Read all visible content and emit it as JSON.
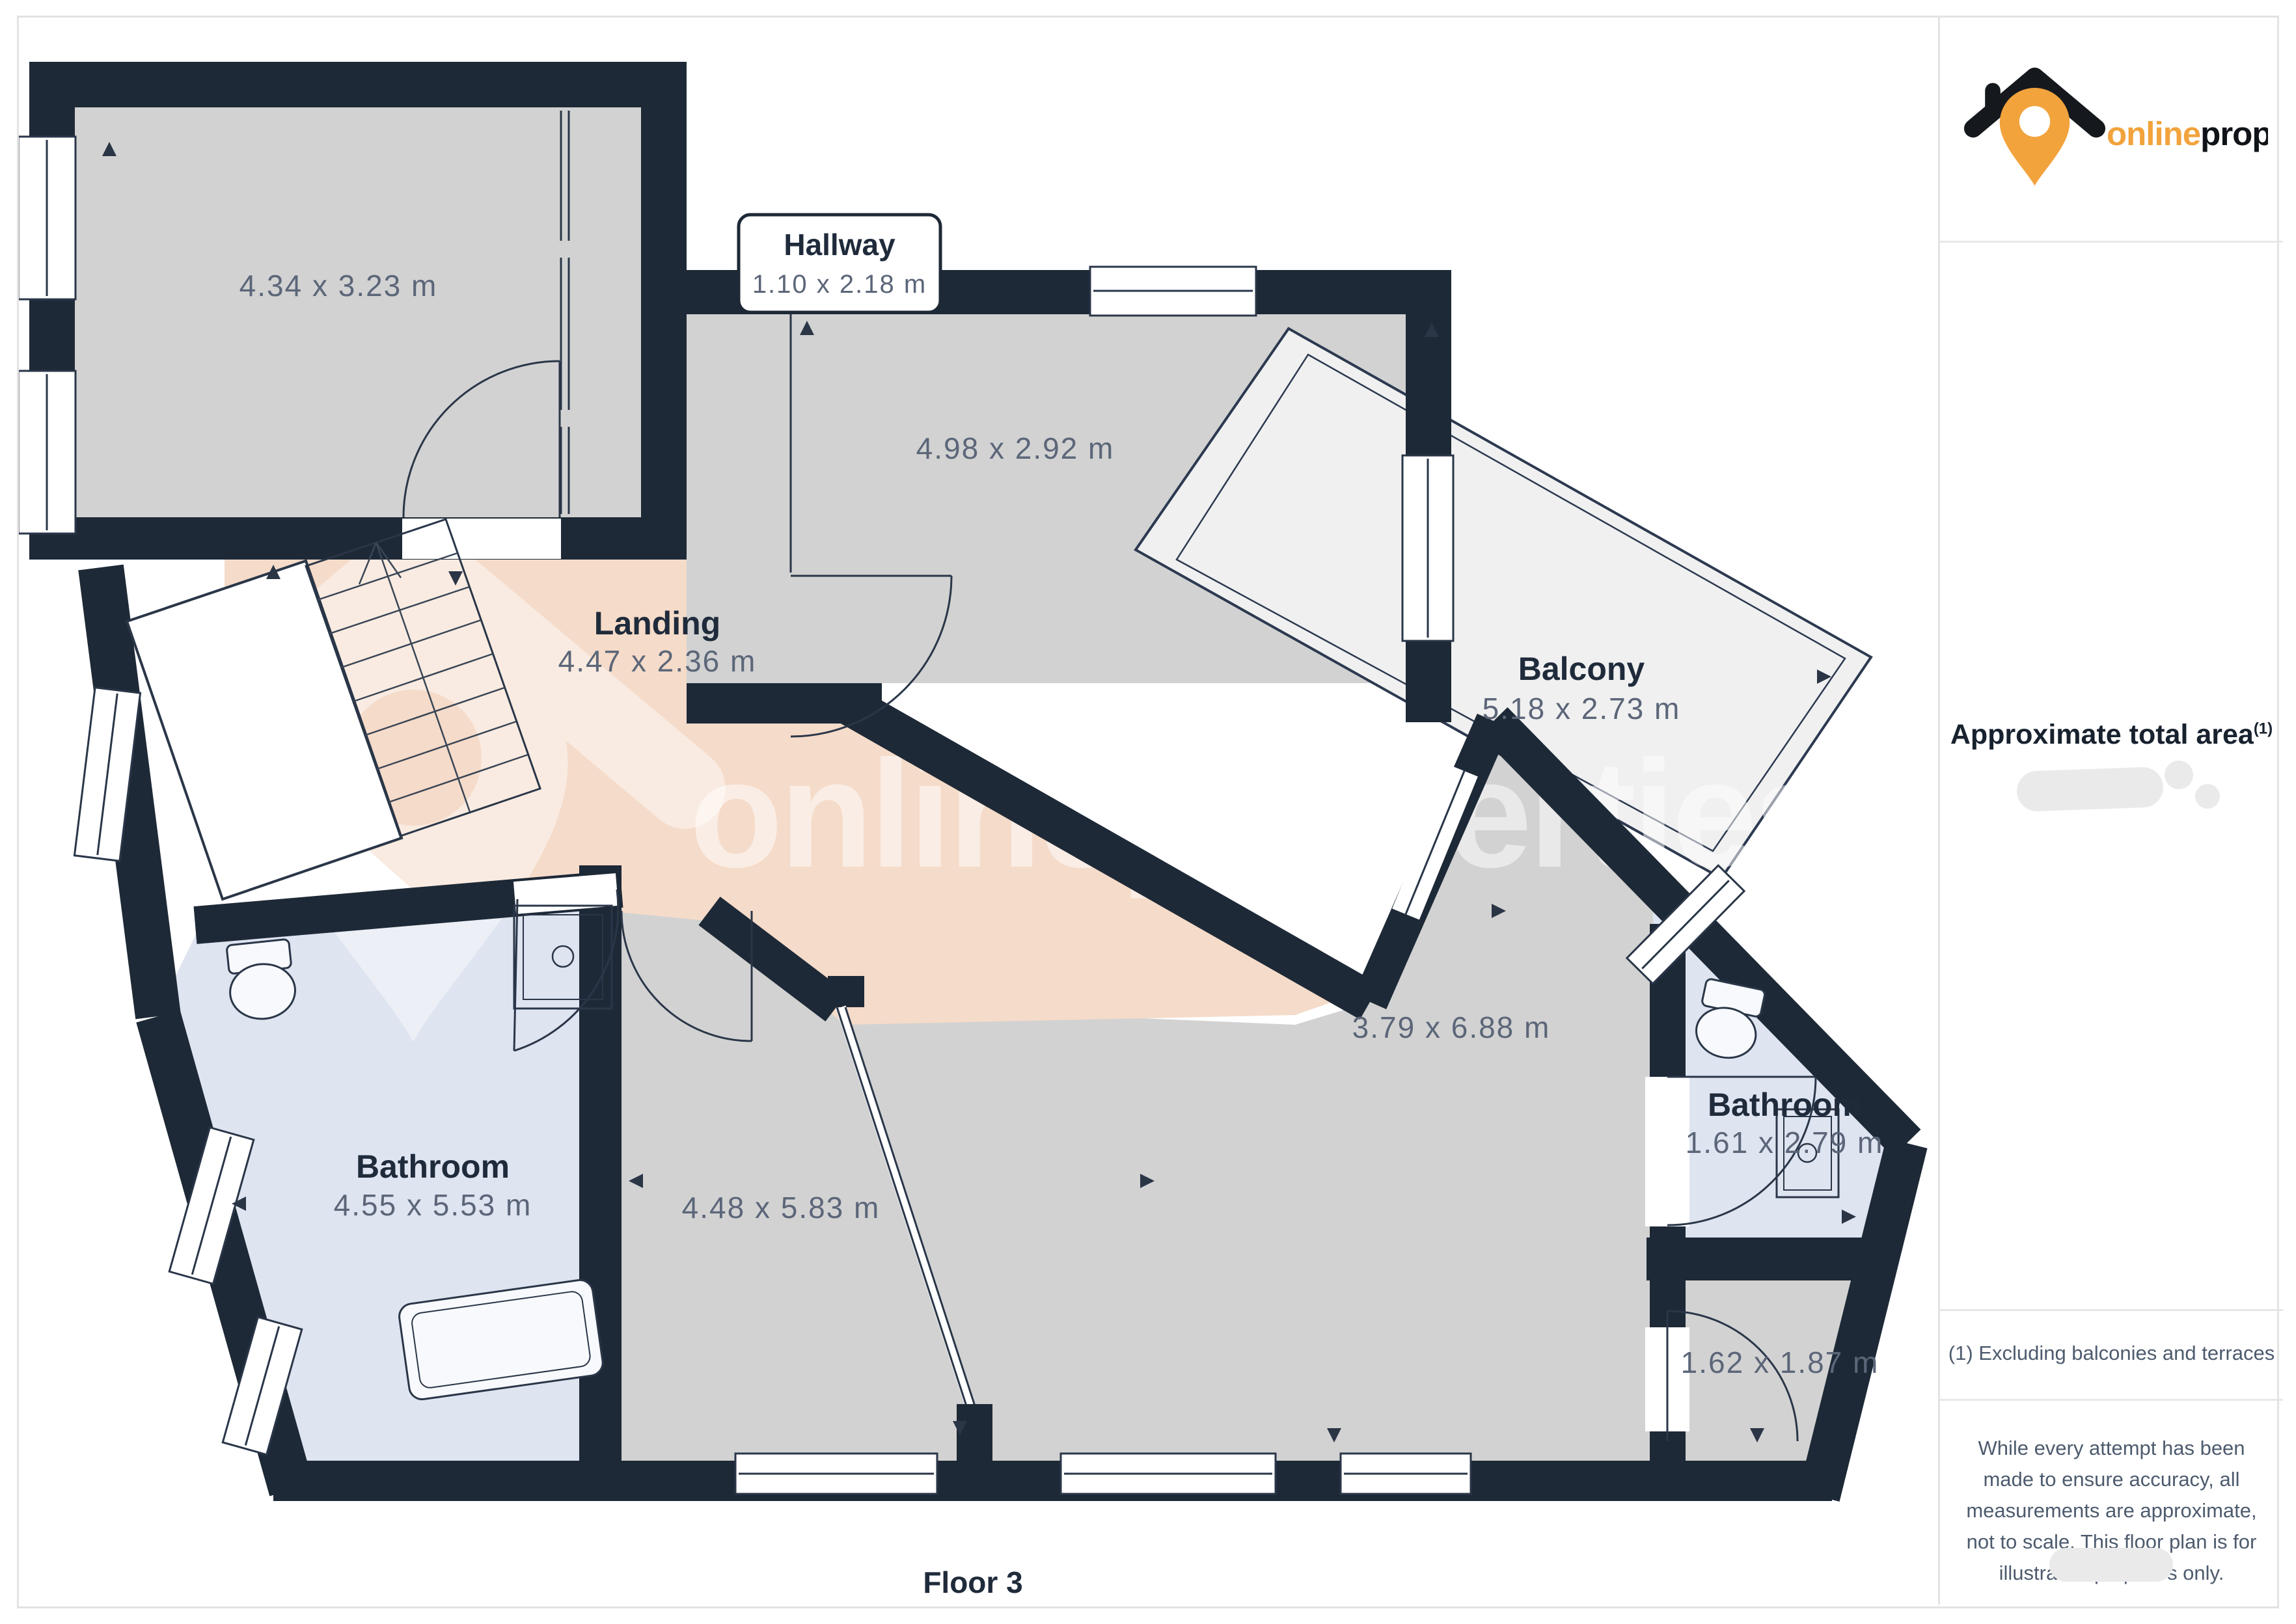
{
  "page": {
    "floor_label": "Floor 3"
  },
  "branding": {
    "name_primary": "online",
    "name_secondary": "properties",
    "logo_icon": "house-pin-icon",
    "accent_color": "#f2a33c",
    "dark_color": "#1e2937"
  },
  "watermark": {
    "text": "onlineproperties"
  },
  "rooms": {
    "bedroom_top_left": {
      "dims": "4.34 x 3.23 m"
    },
    "hallway": {
      "name": "Hallway",
      "dims": "1.10 x 2.18 m"
    },
    "room_top_middle": {
      "dims": "4.98 x 2.92 m"
    },
    "landing": {
      "name": "Landing",
      "dims": "4.47 x 2.36 m"
    },
    "balcony": {
      "name": "Balcony",
      "dims": "5.18 x 2.73 m"
    },
    "bathroom_large": {
      "name": "Bathroom",
      "dims": "4.55 x 5.53 m"
    },
    "room_bottom_middle": {
      "dims": "4.48 x 5.83 m"
    },
    "room_bottom_right": {
      "dims": "3.79 x 6.88 m"
    },
    "bathroom_small": {
      "name": "Bathroom",
      "dims": "1.61 x 2.79 m"
    },
    "storage_room": {
      "dims": "1.62 x 1.87 m"
    }
  },
  "sidebar": {
    "total_area_heading": "Approximate total area",
    "footnote_marker": "(1)",
    "footnote": "(1) Excluding balconies and terraces",
    "disclaimer": "While every attempt has been made to ensure accuracy, all measurements are approximate, not to scale. This floor plan is for illustrative purposes only."
  },
  "colors": {
    "wall": "#1e2937",
    "floor_gray": "#d2d2d2",
    "floor_pink": "#f5dbc9",
    "floor_blue": "#dee4f0",
    "floor_balcony": "#f0f0f0",
    "dim_text": "#5c6679",
    "divider": "#e8e8e8"
  }
}
